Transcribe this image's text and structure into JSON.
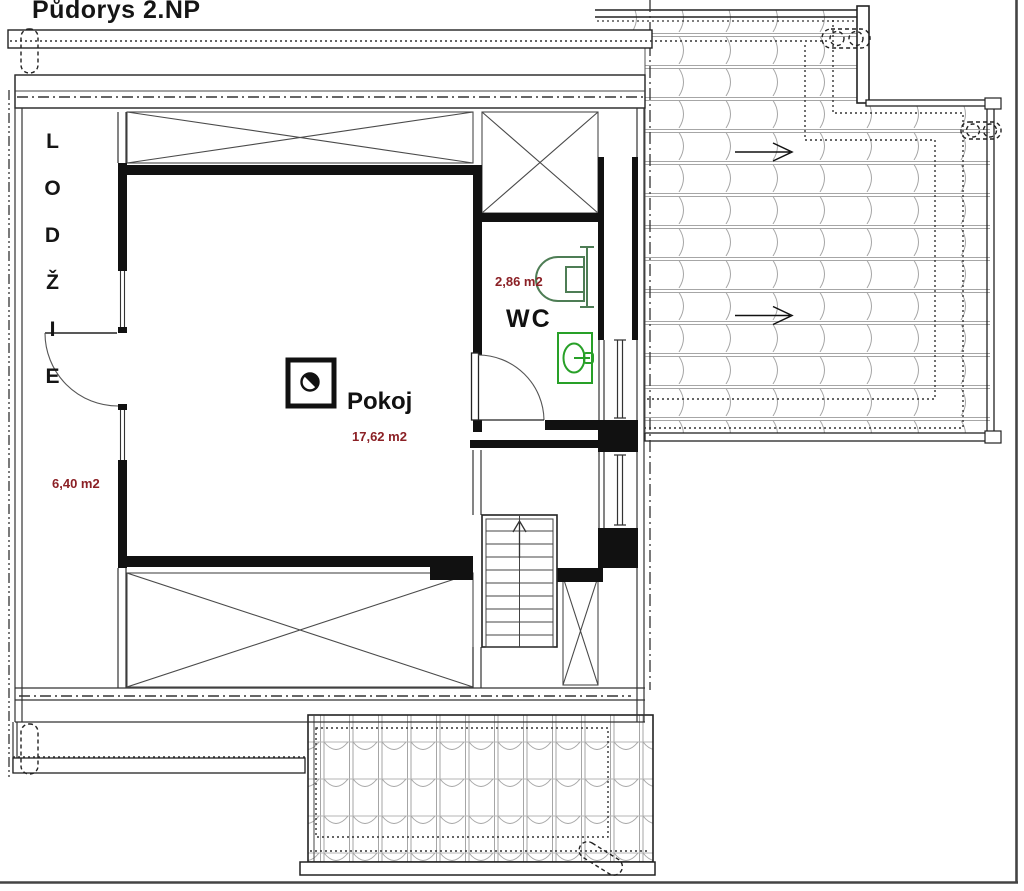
{
  "title": "Půdorys 2.NP",
  "rooms": {
    "loggia": {
      "name": "LODŽIE",
      "area": "6,40 m2"
    },
    "pokoj": {
      "name": "Pokoj",
      "area": "17,62 m2"
    },
    "wc": {
      "name": "WC",
      "area": "2,86 m2"
    }
  },
  "symbols": {
    "toilet_icon": "toilet-plan-symbol",
    "sink_icon": "washbasin-plan-symbol",
    "stairs_icon": "staircase-up-arrow",
    "roof_slope_arrow": "→",
    "chimney_icon": "chimney-flue-square",
    "vent_icon": "dashed-chimney-vent"
  },
  "colors": {
    "wall": "#111111",
    "thin_line": "#333333",
    "tile_line": "#a0a0a0",
    "area_label": "#8b2025",
    "toilet_green": "#4e7d55",
    "sink_green": "#28a028"
  }
}
